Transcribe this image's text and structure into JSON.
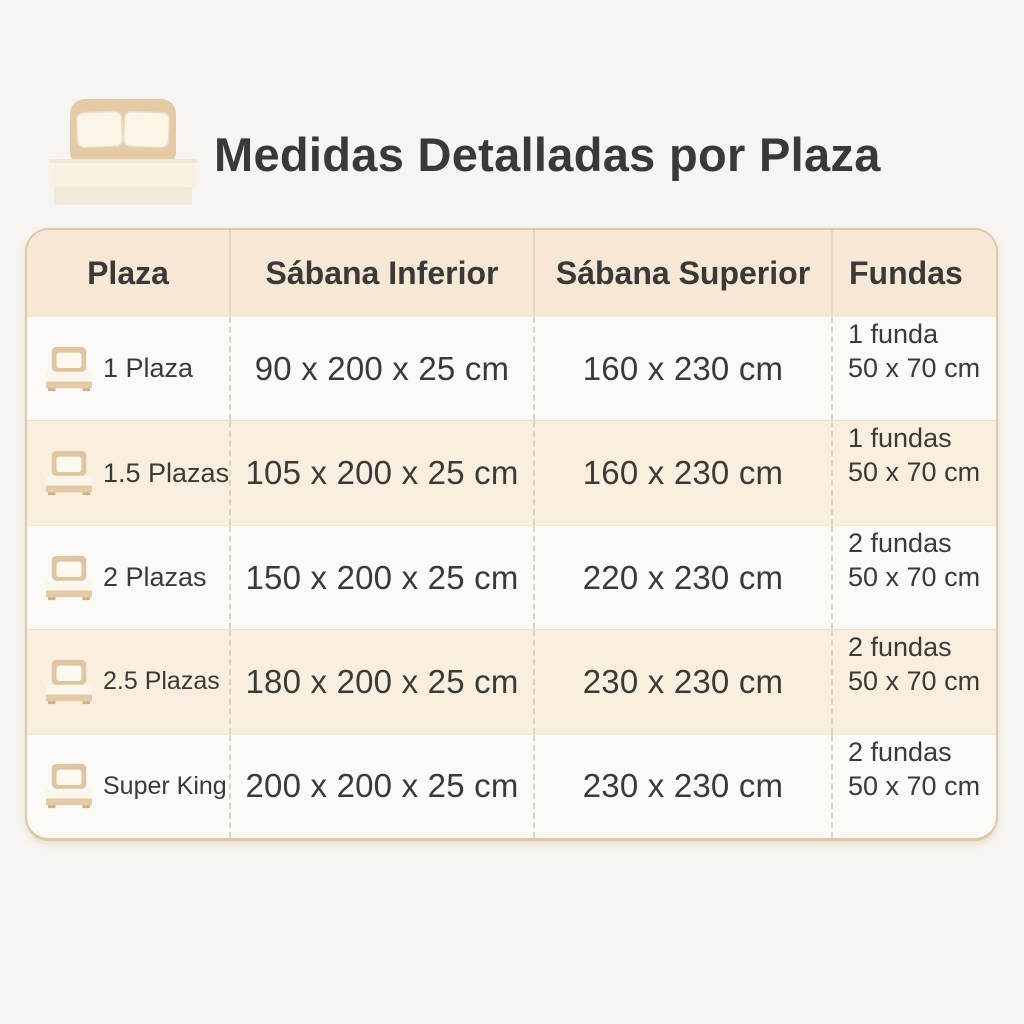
{
  "title": {
    "text": "Medidas Detalladas por Plaza"
  },
  "table": {
    "columns": [
      {
        "label": "Plaza"
      },
      {
        "label": "Sábana Inferior"
      },
      {
        "label": "Sábana Superior"
      },
      {
        "label": "Fundas"
      }
    ],
    "rows": [
      {
        "plaza": "1 Plaza",
        "sabana_inferior": "90 x 200 x 25 cm",
        "sabana_superior": "160 x 230 cm",
        "fundas_line1": "1 funda",
        "fundas_line2": "50 x 70 cm"
      },
      {
        "plaza": "1.5 Plazas",
        "sabana_inferior": "105 x 200 x 25 cm",
        "sabana_superior": "160 x 230 cm",
        "fundas_line1": "1 fundas",
        "fundas_line2": "50 x 70 cm"
      },
      {
        "plaza": "2 Plazas",
        "sabana_inferior": "150 x 200 x 25 cm",
        "sabana_superior": "220 x 230 cm",
        "fundas_line1": "2 fundas",
        "fundas_line2": "50 x 70 cm"
      },
      {
        "plaza": "2.5 Plazas",
        "sabana_inferior": "180 x 200 x 25 cm",
        "sabana_superior": "230 x 230 cm",
        "fundas_line1": "2 fundas",
        "fundas_line2": "50 x 70 cm"
      },
      {
        "plaza": "Super King",
        "sabana_inferior": "200 x 200 x 25 cm",
        "sabana_superior": "230 x 230 cm",
        "fundas_line1": "2 fundas",
        "fundas_line2": "50 x 70 cm"
      }
    ]
  },
  "chart_data": {
    "type": "table",
    "title": "Medidas Detalladas por Plaza",
    "columns": [
      "Plaza",
      "Sábana Inferior",
      "Sábana Superior",
      "Fundas"
    ],
    "rows": [
      [
        "1 Plaza",
        "90 x 200 x 25 cm",
        "160 x 230 cm",
        "1 funda 50 x 70 cm"
      ],
      [
        "1.5 Plazas",
        "105 x 200 x 25 cm",
        "160 x 230 cm",
        "1 fundas 50 x 70 cm"
      ],
      [
        "2 Plazas",
        "150 x 200 x 25 cm",
        "220 x 230 cm",
        "2 fundas 50 x 70 cm"
      ],
      [
        "2.5 Plazas",
        "180 x 200 x 25 cm",
        "230 x 230 cm",
        "2 fundas 50 x 70 cm"
      ],
      [
        "Super King",
        "200 x 200 x 25 cm",
        "230 x 230 cm",
        "2 fundas 50 x 70 cm"
      ]
    ]
  },
  "colors": {
    "page_bg": "#f7f5f2",
    "header_bg": "#f6e8d5",
    "row_bg": "#fcfaf6",
    "row_alt_bg": "#faefdf",
    "card_border": "#dfc8a6",
    "dashed_divider": "#dbd2c4",
    "text": "#3b3a38",
    "bed_tan": "#e4caa5",
    "bed_cream": "#fbf5e8"
  }
}
